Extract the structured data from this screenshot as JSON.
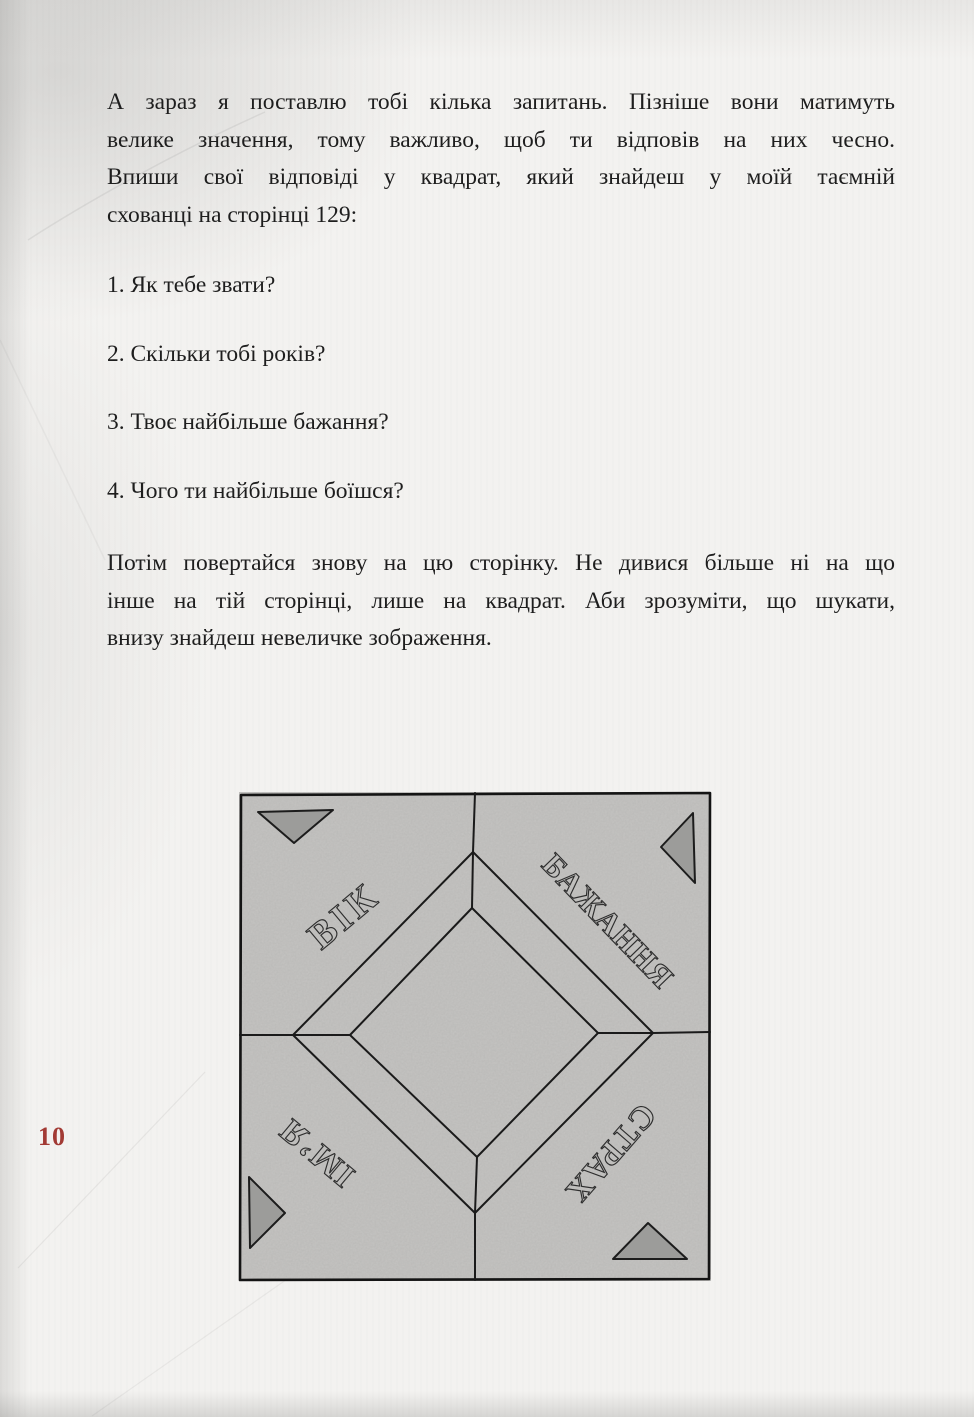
{
  "page": {
    "number": "10",
    "number_color": "#a23a34",
    "paper_color": "#f3f2f0"
  },
  "body": {
    "paragraph1": {
      "lines": [
        "А зараз я поставлю тобі кілька запитань. Пізніше вони матимуть",
        "велике значення, тому важливо, щоб ти відповів на них чесно.",
        "Впиши свої відповіді у квадрат, який знайдеш у моїй таємній",
        "схованці на сторінці 129:"
      ]
    },
    "questions": [
      "1. Як тебе звати?",
      "2. Скільки тобі років?",
      "3. Твоє найбільше бажання?",
      "4. Чого ти найбільше боїшся?"
    ],
    "paragraph2": {
      "lines": [
        "Потім повертайся знову на цю сторінку. Не дивися більше ні на що",
        "інше на тій сторінці, лише на квадрат. Аби зрозуміти, що шукати,",
        "внизу знайдеш невеличке зображення."
      ]
    }
  },
  "illustration": {
    "labels": {
      "top_left": "ВІК",
      "top_right": "БАЖАННЯ",
      "bottom_left": "ІМ’Я",
      "bottom_right": "СТРАХ"
    },
    "paper_color": "#c7c6c4",
    "triangle_color": "#9c9c9a",
    "line_color": "#1a1a1a"
  }
}
